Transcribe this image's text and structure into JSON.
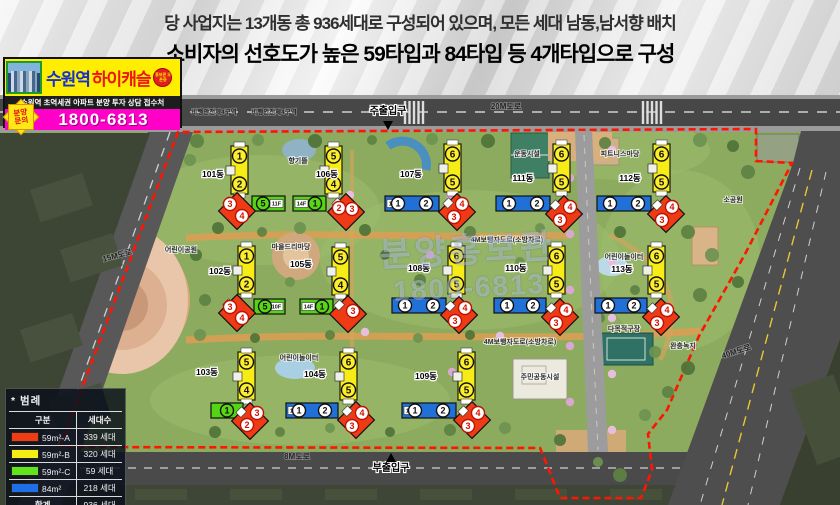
{
  "header": {
    "line1": "당 사업지는 13개동 총 936세대로 구성되어 있으며, 모든 세대 남동,남서향 배치",
    "line2": "소비자의 선호도가 높은 59타입과 84타입 등 4개타입으로 구성"
  },
  "logo": {
    "brand_location": "수원역",
    "brand_name": "하이캐슬",
    "open_badge": "홍보관 오픈중",
    "subtitle": "수원역 초역세권 아파트 분양 투자 상담 접수처",
    "inquiry_badge_line1": "분양",
    "inquiry_badge_line2": "문의",
    "phone": "1800-6813"
  },
  "map": {
    "entrances": {
      "main": {
        "label": "주출입구",
        "x": 388,
        "y": 114
      },
      "sub": {
        "label": "부출입구",
        "x": 391,
        "y": 471
      }
    },
    "road_labels": [
      {
        "text": "20M도로",
        "x": 506,
        "y": 109,
        "rot": 0,
        "fs": 8
      },
      {
        "text": "15M도로",
        "x": 118,
        "y": 258,
        "rot": -15,
        "fs": 8
      },
      {
        "text": "8M도로",
        "x": 297,
        "y": 459,
        "rot": 0,
        "fs": 8
      },
      {
        "text": "40M도로",
        "x": 737,
        "y": 354,
        "rot": -18,
        "fs": 8
      },
      {
        "text": "비행안전제4구역",
        "x": 214,
        "y": 114,
        "rot": 0,
        "fs": 6.5
      },
      {
        "text": "비행안전제4구역",
        "x": 274,
        "y": 114,
        "rot": 0,
        "fs": 6.5
      }
    ],
    "facility_labels": [
      {
        "text": "어린이공원",
        "x": 181,
        "y": 252
      },
      {
        "text": "마을드리마당",
        "x": 291,
        "y": 249
      },
      {
        "text": "향기뜰",
        "x": 298,
        "y": 163
      },
      {
        "text": "운동시설",
        "x": 527,
        "y": 156
      },
      {
        "text": "피트니스마당",
        "x": 620,
        "y": 156
      },
      {
        "text": "소공원",
        "x": 733,
        "y": 202
      },
      {
        "text": "어린이놀이터",
        "x": 624,
        "y": 259
      },
      {
        "text": "어린이놀이터",
        "x": 299,
        "y": 360
      },
      {
        "text": "다목적구장",
        "x": 624,
        "y": 331
      },
      {
        "text": "주민공동시설",
        "x": 540,
        "y": 379
      },
      {
        "text": "완충녹지",
        "x": 683,
        "y": 348
      },
      {
        "text": "4M보행자도로(소방차로)",
        "x": 507,
        "y": 242
      },
      {
        "text": "4M보행자도로(소방차로)",
        "x": 520,
        "y": 344
      }
    ],
    "watermark": {
      "line1": "분양홍보관",
      "line2": "1800-6813"
    },
    "buildings": [
      {
        "name": "101동",
        "lx": 213,
        "ly": 177,
        "tower": {
          "x": 231,
          "y": 146,
          "nums": [
            1,
            2
          ]
        },
        "bar": {
          "x": 252,
          "y": 196,
          "w": 33,
          "color": "green",
          "nums": [
            5
          ],
          "numAt": "left",
          "floor": "11F",
          "floorAt": "right"
        },
        "diamond": {
          "cx": 237,
          "cy": 211,
          "nums": [
            {
              "n": 3,
              "dx": -7,
              "dy": -7
            },
            {
              "n": 4,
              "dx": 5,
              "dy": 5
            }
          ]
        }
      },
      {
        "name": "106동",
        "lx": 327,
        "ly": 177,
        "tower": {
          "x": 325,
          "y": 146,
          "nums": [
            5,
            4
          ]
        },
        "bar": {
          "x": 293,
          "y": 196,
          "w": 33,
          "color": "green",
          "nums": [
            1
          ],
          "numAt": "right",
          "floor": "14F",
          "floorAt": "left"
        },
        "diamond": {
          "cx": 346,
          "cy": 212,
          "nums": [
            {
              "n": 2,
              "dx": -7,
              "dy": -4
            },
            {
              "n": 3,
              "dx": 6,
              "dy": -3
            }
          ]
        }
      },
      {
        "name": "107동",
        "lx": 411,
        "ly": 177,
        "tower": {
          "x": 444,
          "y": 144,
          "nums": [
            6,
            5
          ]
        },
        "bar": {
          "x": 385,
          "y": 196,
          "w": 54,
          "color": "blue",
          "nums": [
            1,
            2
          ],
          "floor": "14F",
          "floorAt": "left"
        },
        "diamond": {
          "cx": 457,
          "cy": 212,
          "nums": [
            {
              "n": 4,
              "dx": 5,
              "dy": -8
            },
            {
              "n": 3,
              "dx": -3,
              "dy": 5
            }
          ]
        }
      },
      {
        "name": "111동",
        "lx": 523,
        "ly": 181,
        "tower": {
          "x": 553,
          "y": 144,
          "nums": [
            6,
            5
          ]
        },
        "bar": {
          "x": 496,
          "y": 196,
          "w": 54,
          "color": "blue",
          "nums": [
            1,
            2
          ]
        },
        "diamond": {
          "cx": 564,
          "cy": 214,
          "nums": [
            {
              "n": 4,
              "dx": 6,
              "dy": -7
            },
            {
              "n": 3,
              "dx": -4,
              "dy": 6
            }
          ]
        }
      },
      {
        "name": "112동",
        "lx": 630,
        "ly": 181,
        "tower": {
          "x": 653,
          "y": 144,
          "nums": [
            6,
            5
          ]
        },
        "bar": {
          "x": 597,
          "y": 196,
          "w": 54,
          "color": "blue",
          "nums": [
            1,
            2
          ]
        },
        "diamond": {
          "cx": 666,
          "cy": 214,
          "nums": [
            {
              "n": 4,
              "dx": 6,
              "dy": -7
            },
            {
              "n": 3,
              "dx": -4,
              "dy": 6
            }
          ]
        }
      },
      {
        "name": "102동",
        "lx": 220,
        "ly": 274,
        "tower": {
          "x": 238,
          "y": 246,
          "nums": [
            1,
            2
          ]
        },
        "bar": {
          "x": 254,
          "y": 299,
          "w": 31,
          "color": "green",
          "nums": [
            5
          ],
          "numAt": "left",
          "floor": "10F",
          "floorAt": "right"
        },
        "diamond": {
          "cx": 237,
          "cy": 313,
          "nums": [
            {
              "n": 3,
              "dx": -7,
              "dy": -6
            },
            {
              "n": 4,
              "dx": 5,
              "dy": 5
            }
          ]
        }
      },
      {
        "name": "105동",
        "lx": 301,
        "ly": 267,
        "tower": {
          "x": 332,
          "y": 247,
          "nums": [
            5,
            4
          ]
        },
        "bar": {
          "x": 300,
          "y": 299,
          "w": 33,
          "color": "green",
          "nums": [
            1
          ],
          "numAt": "right",
          "floor": "14F",
          "floorAt": "left"
        },
        "diamond": {
          "cx": 348,
          "cy": 314,
          "nums": [
            {
              "n": 3,
              "dx": 5,
              "dy": -3
            }
          ]
        }
      },
      {
        "name": "108동",
        "lx": 419,
        "ly": 271,
        "tower": {
          "x": 448,
          "y": 246,
          "nums": [
            6,
            5
          ]
        },
        "bar": {
          "x": 392,
          "y": 298,
          "w": 54,
          "color": "blue",
          "nums": [
            1,
            2
          ]
        },
        "diamond": {
          "cx": 459,
          "cy": 315,
          "nums": [
            {
              "n": 4,
              "dx": 6,
              "dy": -7
            },
            {
              "n": 3,
              "dx": -4,
              "dy": 6
            }
          ]
        }
      },
      {
        "name": "110동",
        "lx": 516,
        "ly": 271,
        "tower": {
          "x": 548,
          "y": 246,
          "nums": [
            6,
            5
          ]
        },
        "bar": {
          "x": 494,
          "y": 298,
          "w": 52,
          "color": "blue",
          "nums": [
            1,
            2
          ]
        },
        "diamond": {
          "cx": 560,
          "cy": 317,
          "nums": [
            {
              "n": 4,
              "dx": 6,
              "dy": -7
            },
            {
              "n": 3,
              "dx": -4,
              "dy": 6
            }
          ]
        }
      },
      {
        "name": "113동",
        "lx": 622,
        "ly": 272,
        "tower": {
          "x": 648,
          "y": 246,
          "nums": [
            6,
            5
          ]
        },
        "bar": {
          "x": 595,
          "y": 298,
          "w": 52,
          "color": "blue",
          "nums": [
            1,
            2
          ]
        },
        "diamond": {
          "cx": 661,
          "cy": 317,
          "nums": [
            {
              "n": 4,
              "dx": 6,
              "dy": -7
            },
            {
              "n": 3,
              "dx": -4,
              "dy": 6
            }
          ]
        }
      },
      {
        "name": "103동",
        "lx": 207,
        "ly": 375,
        "tower": {
          "x": 238,
          "y": 352,
          "nums": [
            5,
            4
          ]
        },
        "bar": {
          "x": 211,
          "y": 403,
          "w": 32,
          "color": "green",
          "nums": [
            1
          ],
          "numAt": "center"
        },
        "diamond": {
          "cx": 250,
          "cy": 421,
          "nums": [
            {
              "n": 3,
              "dx": 7,
              "dy": -8
            },
            {
              "n": 2,
              "dx": -3,
              "dy": 4
            }
          ]
        }
      },
      {
        "name": "104동",
        "lx": 315,
        "ly": 377,
        "tower": {
          "x": 340,
          "y": 352,
          "nums": [
            6,
            5
          ]
        },
        "bar": {
          "x": 286,
          "y": 403,
          "w": 52,
          "color": "blue",
          "nums": [
            1,
            2
          ],
          "floor": "11F",
          "floorAt": "left"
        },
        "diamond": {
          "cx": 356,
          "cy": 420,
          "nums": [
            {
              "n": 4,
              "dx": 6,
              "dy": -7
            },
            {
              "n": 3,
              "dx": -4,
              "dy": 6
            }
          ]
        }
      },
      {
        "name": "109동",
        "lx": 426,
        "ly": 379,
        "tower": {
          "x": 458,
          "y": 352,
          "nums": [
            6,
            5
          ]
        },
        "bar": {
          "x": 402,
          "y": 403,
          "w": 54,
          "color": "blue",
          "nums": [
            1,
            2
          ],
          "floor": "14F",
          "floorAt": "left"
        },
        "diamond": {
          "cx": 472,
          "cy": 420,
          "nums": [
            {
              "n": 4,
              "dx": 6,
              "dy": -7
            },
            {
              "n": 3,
              "dx": -4,
              "dy": 6
            }
          ]
        }
      }
    ]
  },
  "legend": {
    "title": "* 범례",
    "col1": "구분",
    "col2": "세대수",
    "rows": [
      {
        "type": "59m²-A",
        "color": "#f03c14",
        "count": "339 세대"
      },
      {
        "type": "59m²-B",
        "color": "#f5ee16",
        "count": "320 세대"
      },
      {
        "type": "59m²-C",
        "color": "#62e41c",
        "count": "59 세대"
      },
      {
        "type": "84m²",
        "color": "#1e6ee8",
        "count": "218 세대"
      }
    ],
    "total_label": "합계",
    "total": "936 세대"
  }
}
